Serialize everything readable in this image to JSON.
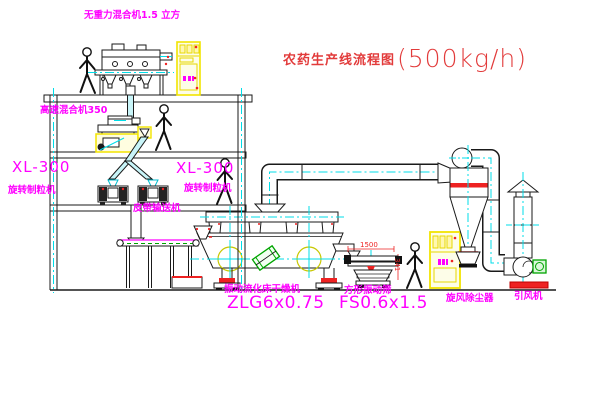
{
  "window": {
    "width": 600,
    "height": 403,
    "background": "#ffffff"
  },
  "title": {
    "text": "农药生产线流程图",
    "capacity": "(500kg/h)",
    "color": "#e23b3b"
  },
  "equipment_labels": {
    "gravityless_mixer": "无重力混合机1.5 立方",
    "high_speed_mixer": "高速混合机350",
    "granulator_left_model": "XL-300",
    "granulator_left_name": "旋转制粒机",
    "granulator_center_model": "XL-300",
    "granulator_center_name": "旋转制粒机",
    "belt_conveyor": "皮带输送机",
    "fluid_bed_dryer_name": "振动流化床干燥机",
    "fluid_bed_dryer_model": "ZLG6x0.75",
    "vibrating_screen_name": "方形振动筛",
    "vibrating_screen_model": "FS0.6x1.5",
    "cyclone_dust_collector": "旋风除尘器",
    "induced_draft_fan": "引风机"
  },
  "dimensions": {
    "screen_length": "1500",
    "screen_height": "341"
  },
  "palette": {
    "annotation_magenta": "#ff00ff",
    "title_red": "#e23b3b",
    "centerline_cyan": "#00dde8",
    "highlight_yellow": "#f2e400",
    "line_black": "#1a1a1a",
    "accent_red": "#ee2222",
    "accent_green": "#00a400"
  }
}
